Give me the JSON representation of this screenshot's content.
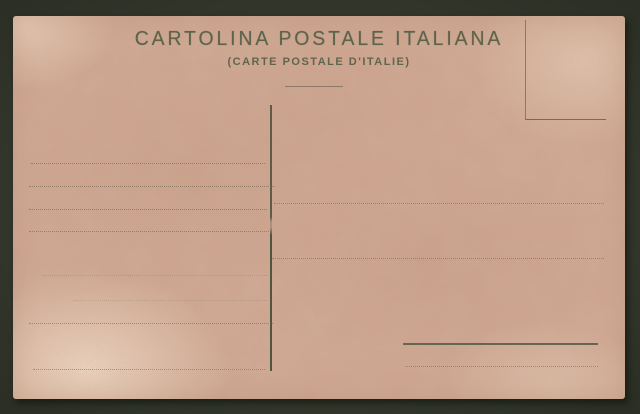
{
  "postcard": {
    "title": "CARTOLINA POSTALE ITALIANA",
    "subtitle": "(CARTE POSTALE D'ITALIE)"
  },
  "colors": {
    "background": "#3a3f31",
    "paper": "#cfa58f",
    "paper_light": "#ecd3bd",
    "ink": "#4e5a42",
    "rule_dark": "#54584a",
    "rule_dotted": "#85735f"
  },
  "ruling": {
    "message_lines": [
      {
        "top": 147,
        "left": 18,
        "width": 234,
        "opacity": 0.75
      },
      {
        "top": 170,
        "left": 16,
        "width": 246,
        "opacity": 0.8
      },
      {
        "top": 193,
        "left": 16,
        "width": 238,
        "opacity": 0.8
      },
      {
        "top": 215,
        "left": 16,
        "width": 242,
        "opacity": 0.75
      },
      {
        "top": 259,
        "left": 30,
        "width": 228,
        "opacity": 0.35
      },
      {
        "top": 284,
        "left": 60,
        "width": 198,
        "opacity": 0.3
      },
      {
        "top": 307,
        "left": 16,
        "width": 244,
        "opacity": 0.7
      },
      {
        "top": 353,
        "left": 20,
        "width": 232,
        "opacity": 0.65
      }
    ],
    "address_lines": [
      {
        "top": 187,
        "left": 261,
        "width": 330,
        "opacity": 0.7
      },
      {
        "top": 242,
        "left": 259,
        "width": 332,
        "opacity": 0.7
      },
      {
        "top": 350,
        "left": 392,
        "width": 193,
        "opacity": 0.7
      }
    ],
    "signature_line": {
      "top": 327,
      "left": 390,
      "width": 195,
      "opacity": 0.85
    }
  }
}
